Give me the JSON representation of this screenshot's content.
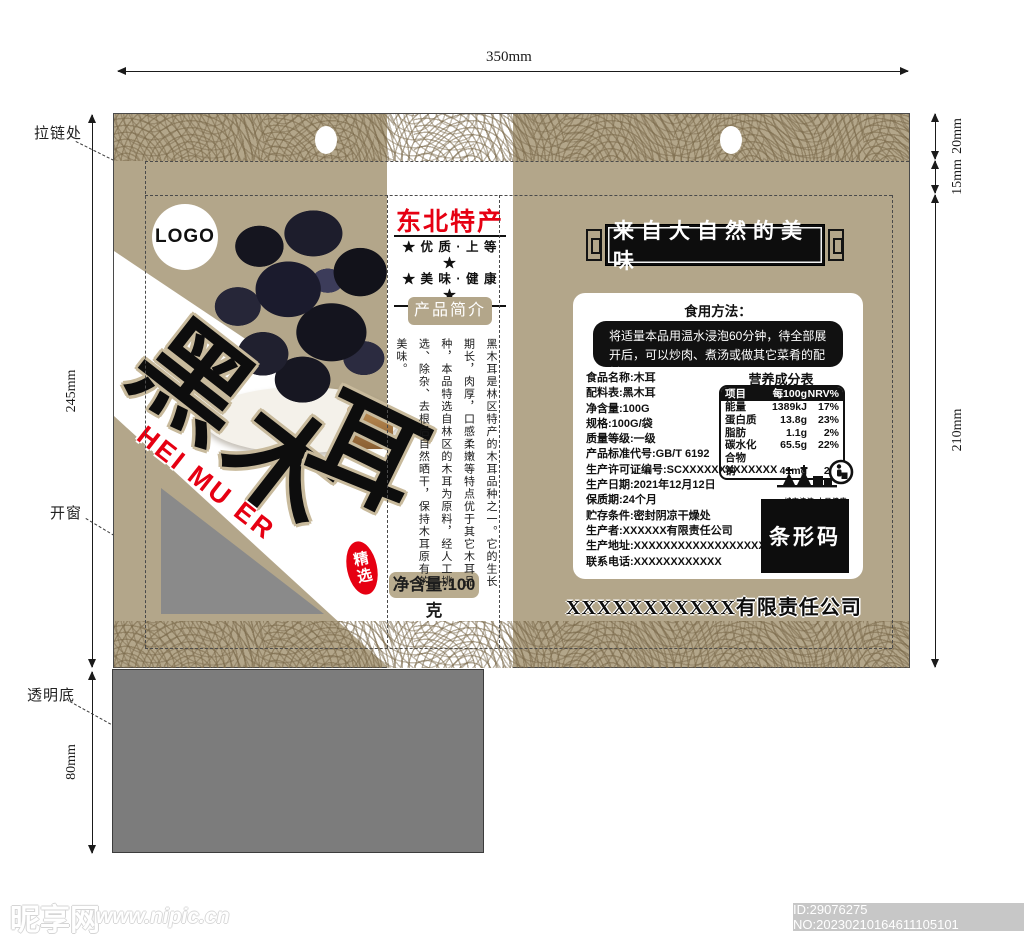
{
  "annotations": {
    "width_top": "350mm",
    "right_dims": [
      "20mm",
      "15mm",
      "210mm"
    ],
    "left_height": "245mm",
    "bottom_height": "80mm",
    "zipper_label": "拉链处",
    "window_label": "开窗",
    "clear_bottom_label": "透明底"
  },
  "front": {
    "logo": "LOGO",
    "brand_chars": [
      "黑",
      "木",
      "耳"
    ],
    "pinyin": "HEI MU ER",
    "seal": "精选",
    "net_weight": "净含量:100克",
    "origin_title": "东北特产",
    "slogan1": "★ 优 质 · 上 等 ★",
    "slogan2": "★ 美 味 · 健 康 ★",
    "intro_button": "产品简介",
    "intro_text": "黑木耳是林区特产的木耳品种之一。它的生长期长，肉厚，口感柔嫩等特点优于其它木耳品种，本品特选自林区的木耳为原料，经人工挑选、除杂、去根后自然晒干，保持木耳原有的美味。"
  },
  "back": {
    "plaque": "来自大自然的美味",
    "usage_title": "食用方法：",
    "usage_text": "将适量本品用温水浸泡60分钟，待全部展\n开后，可以炒肉、煮汤或做其它菜肴的配料。",
    "info_lines": [
      "食品名称:木耳",
      "配料表:黑木耳",
      "净含量:100G",
      "规格:100G/袋",
      "质量等级:一级",
      "产品标准代号:GB/T 6192",
      "生产许可证编号:SCXXXXXXXXXXXXX",
      "生产日期:2021年12月12日",
      "保质期:24个月",
      "贮存条件:密封阴凉干燥处",
      "生产者:XXXXXX有限责任公司",
      "生产地址:XXXXXXXXXXXXXXXXXXX",
      "联系电话:XXXXXXXXXXXX"
    ],
    "nutrition": {
      "title": "营养成分表",
      "head": [
        "项目",
        "每100g",
        "NRV%"
      ],
      "rows": [
        [
          "能量",
          "1389kJ",
          "17%"
        ],
        [
          "蛋白质",
          "13.8g",
          "23%"
        ],
        [
          "脂肪",
          "1.1g",
          "2%"
        ],
        [
          "碳水化合物",
          "65.5g",
          "22%"
        ],
        [
          "钠",
          "41mg",
          "2%"
        ]
      ]
    },
    "eco_caption": "城市清洁 人民健康",
    "barcode": "条形码",
    "company": "XXXXXXXXXXX有限责任公司"
  },
  "watermark": {
    "site": "昵享网",
    "url": "www.nipic.cn",
    "id_text": "ID:29076275 NO:20230210164611105101"
  }
}
